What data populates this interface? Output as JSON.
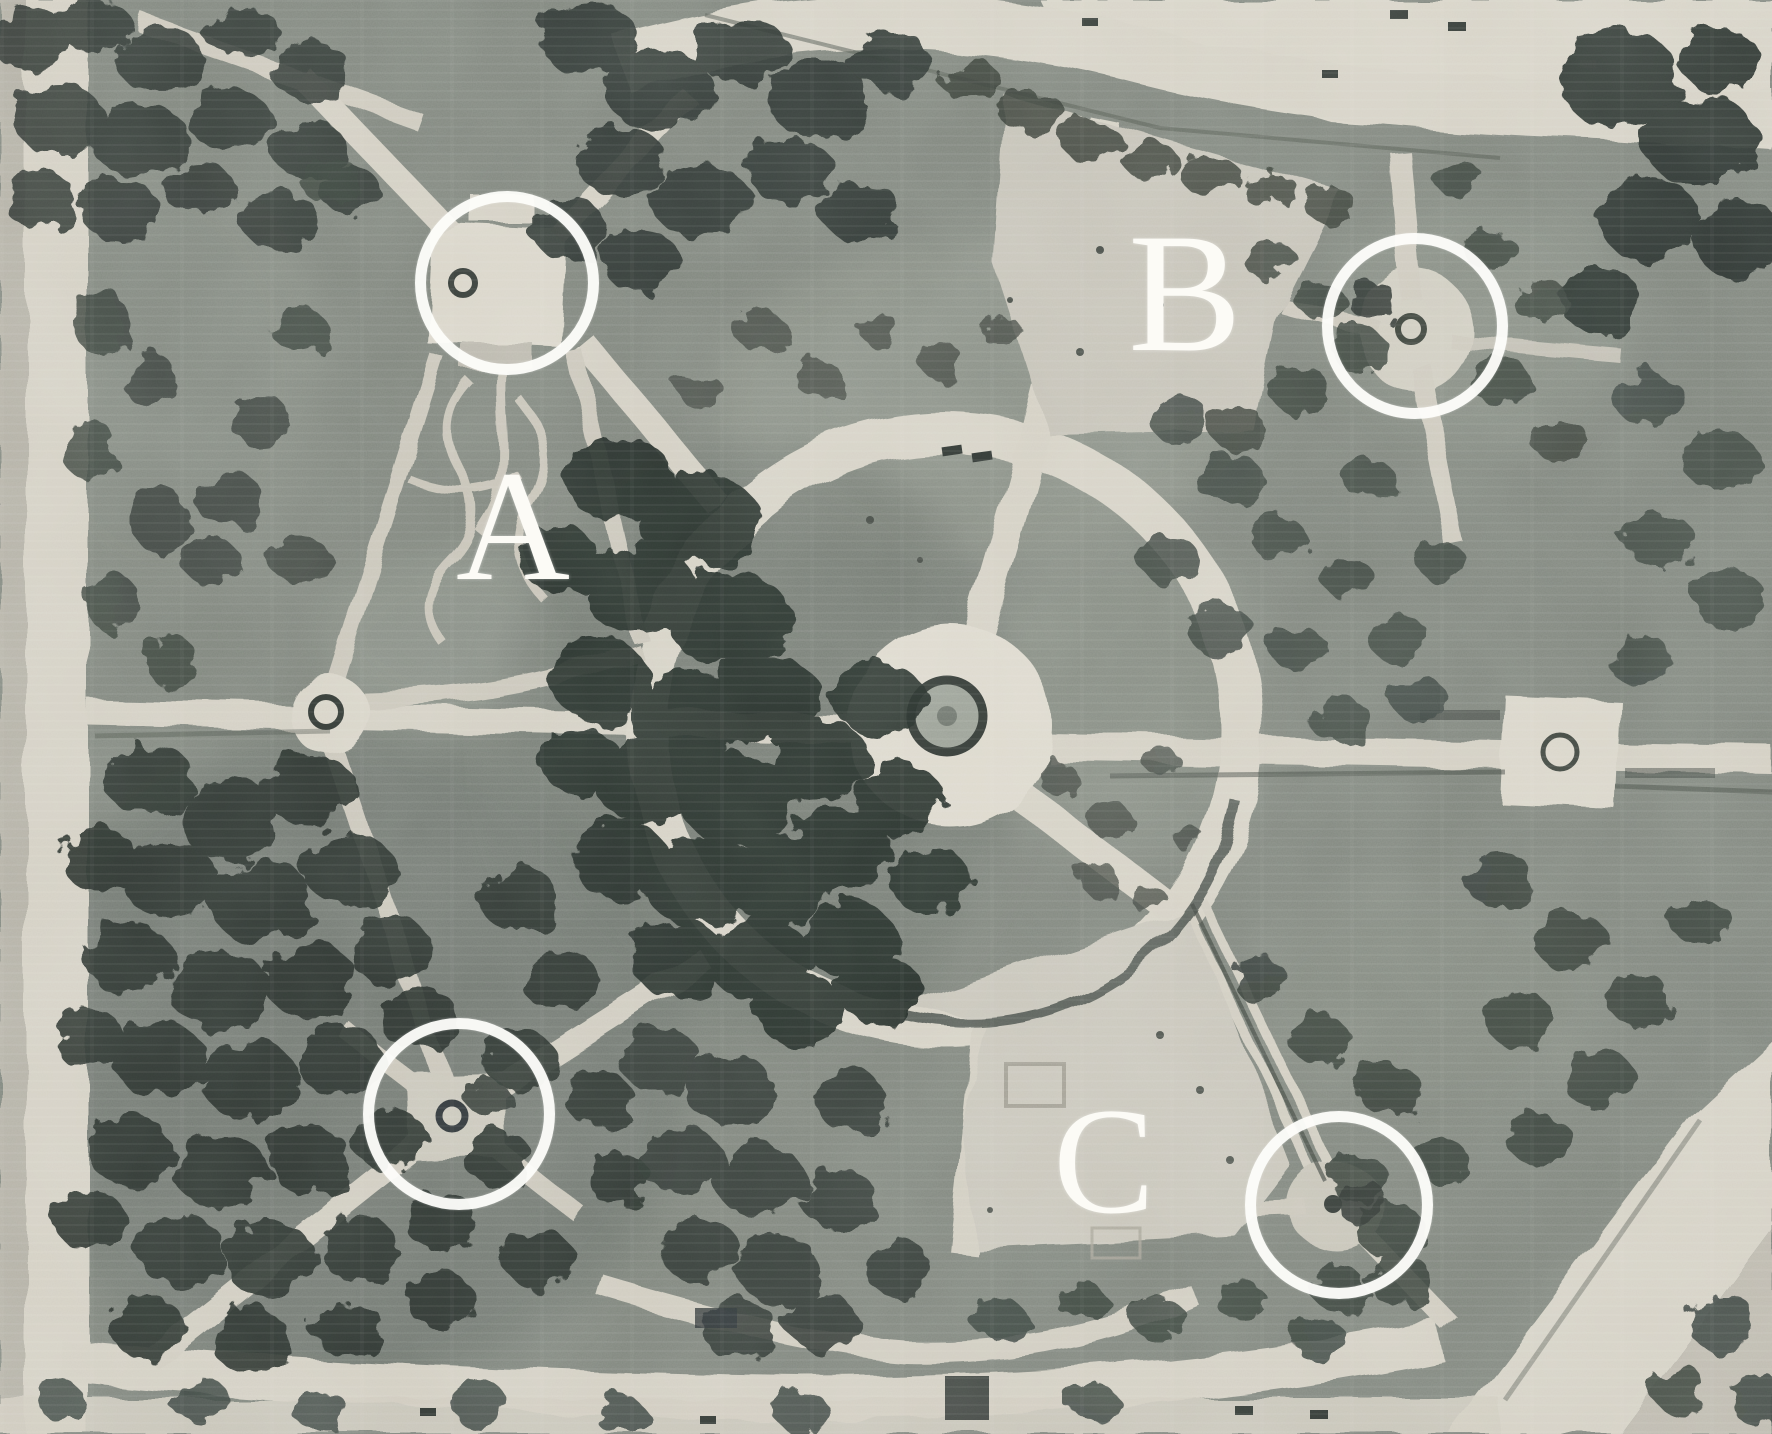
{
  "meta": {
    "title": "Annotated aerial photograph of a formal park",
    "media": "black-and-white aerial photograph"
  },
  "photo": {
    "description": "Vertical aerial photograph of a park laid out around a central circular plaza with a fountain, surrounded by a large ring walkway with radiating paths, dense tree groves, lighter lawn sectors, corner monuments and bordering streets.",
    "palette": {
      "path_light": "#d5d1c5",
      "plaza_light": "#ddd9cd",
      "lawn_mid": "#7e847c",
      "trees_dark": "#2a302d",
      "annotation_white": "#ffffff"
    }
  },
  "annotations": {
    "letters": [
      {
        "label": "A",
        "x": 513,
        "y": 527
      },
      {
        "label": "B",
        "x": 1185,
        "y": 293
      },
      {
        "label": "C",
        "x": 1104,
        "y": 1161
      }
    ],
    "circles": [
      {
        "id": "top-left",
        "cx": 507,
        "cy": 283,
        "r": 92
      },
      {
        "id": "top-right",
        "cx": 1415,
        "cy": 326,
        "r": 93
      },
      {
        "id": "bottom-left",
        "cx": 459,
        "cy": 1114,
        "r": 96
      },
      {
        "id": "bottom-right",
        "cx": 1339,
        "cy": 1205,
        "r": 94
      }
    ]
  }
}
